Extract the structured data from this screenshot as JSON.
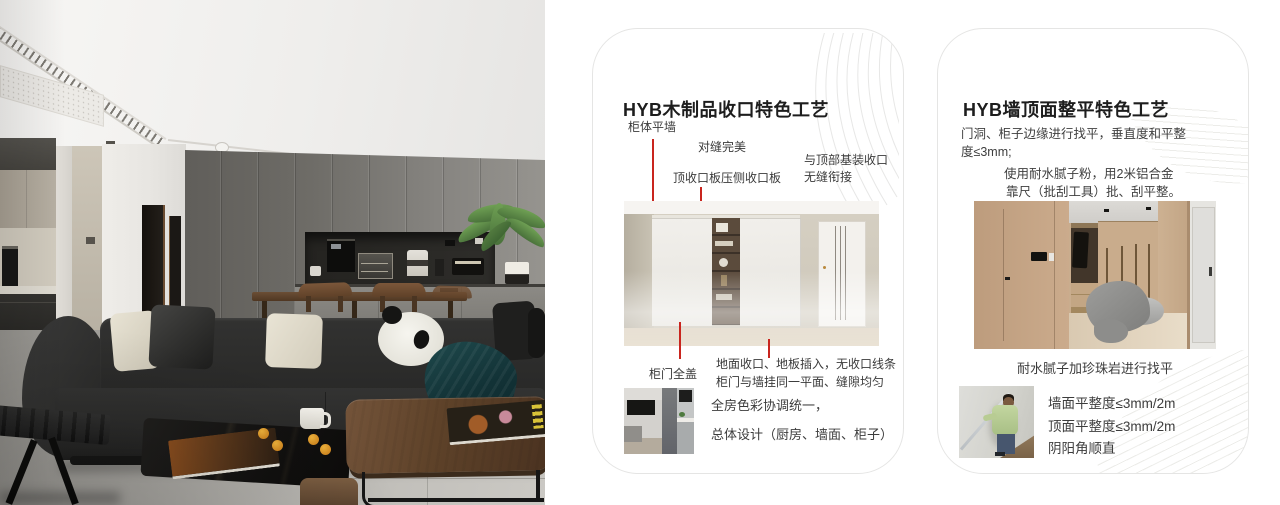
{
  "colors": {
    "accent_red": "#c9251e",
    "card_border": "#e5e5e4",
    "page_background": "#ffffff"
  },
  "photo": {
    "description": "modern living room with dark sofa, panda cushion, coffee niche and dining set"
  },
  "cards": [
    {
      "title": "HYB木制品收口特色工艺",
      "callouts": {
        "cabinet_flush_with_wall": "柜体平墙",
        "perfect_seams": "对缝完美",
        "top_closing_board": "顶收口板压侧收口板",
        "ceiling_joint_line1": "与顶部基装收口",
        "ceiling_joint_line2": "无缝衔接",
        "full_overlay_doors": "柜门全盖",
        "floor_closing_line1": "地面收口、地板插入，无收口线条",
        "floor_closing_line2": "柜门与墙挂同一平面、缝隙均匀"
      },
      "summary_line1": "全房色彩协调统一，",
      "summary_line2": "总体设计（厨房、墙面、柜子）"
    },
    {
      "title": "HYB墙顶面整平特色工艺",
      "paragraph1_line1": "门洞、柜子边缘进行找平，垂直度和平整",
      "paragraph1_line2": "度≤3mm;",
      "paragraph2_line1": "使用耐水腻子粉，用2米铝合金",
      "paragraph2_line2": "靠尺（批刮工具）批、刮平整。",
      "image_caption": "耐水腻子加珍珠岩进行找平",
      "metrics": [
        "墙面平整度≤3mm/2m",
        "顶面平整度≤3mm/2m",
        "阴阳角顺直"
      ]
    }
  ]
}
